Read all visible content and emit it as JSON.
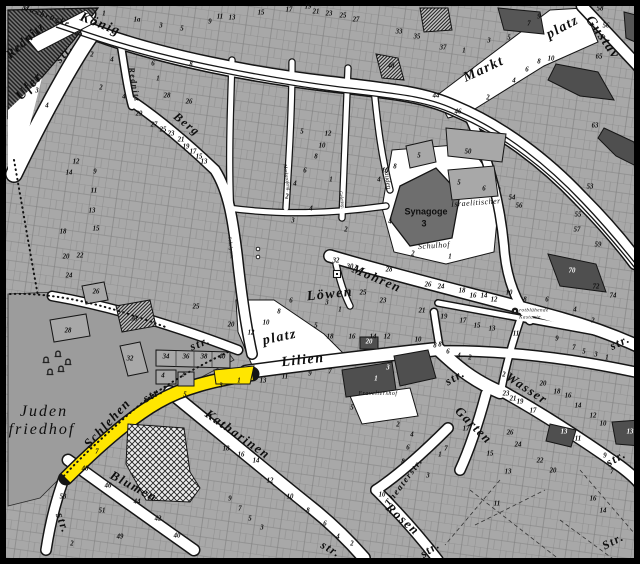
{
  "map": {
    "colors": {
      "highlight": "#ffe600",
      "block": "#a8a8a8",
      "block_dark": "#4f4f4f",
      "street": "#ffffff",
      "outline": "#151515",
      "cemetery": "#9c9c9c",
      "river": "#7c7c7c"
    },
    "street_labels": [
      {
        "t": "Maxbrücke",
        "x": 46,
        "y": 16,
        "r": 20,
        "s": 8,
        "n": "label-maxbruecke"
      },
      {
        "t": "Rednitz",
        "x": 25,
        "y": 40,
        "r": -42,
        "s": 13,
        "c": "riv",
        "n": "label-rednitz-river"
      },
      {
        "t": "König",
        "x": 100,
        "y": 25,
        "r": 22,
        "s": 14,
        "n": "label-koenigstrasse"
      },
      {
        "t": "str.",
        "x": 64,
        "y": 53,
        "r": -50,
        "s": 12,
        "n": "label-ufer-str-suffix"
      },
      {
        "t": "Ufer",
        "x": 30,
        "y": 87,
        "r": -47,
        "s": 14,
        "n": "label-uferstrasse"
      },
      {
        "t": "Rednitz",
        "x": 134,
        "y": 85,
        "r": 80,
        "s": 8,
        "n": "label-rednitzgasse"
      },
      {
        "t": "Berg",
        "x": 187,
        "y": 124,
        "r": 38,
        "s": 12,
        "n": "label-bergstrasse"
      },
      {
        "t": "Markt",
        "x": 484,
        "y": 70,
        "r": -25,
        "s": 14,
        "n": "label-marktplatz"
      },
      {
        "t": "platz",
        "x": 563,
        "y": 28,
        "r": -28,
        "s": 14,
        "n": "label-marktplatz-suffix"
      },
      {
        "t": "Gustav",
        "x": 602,
        "y": 38,
        "r": 55,
        "s": 14,
        "n": "label-gustavstrasse"
      },
      {
        "t": "Stauden",
        "x": 387,
        "y": 178,
        "r": 82,
        "s": 7,
        "c": "tiny",
        "n": "label-staudengasse"
      },
      {
        "t": "Markgrafeng.",
        "x": 286,
        "y": 178,
        "r": 82,
        "s": 5,
        "c": "tiny",
        "n": "label-markgrafengasse"
      },
      {
        "t": "Geleitsg.",
        "x": 341,
        "y": 200,
        "r": 82,
        "s": 5,
        "c": "tiny",
        "n": "label-geleitsgasse"
      },
      {
        "t": "Schulgasse",
        "x": 230,
        "y": 248,
        "r": 84,
        "s": 5,
        "c": "tiny",
        "n": "label-schulgasse"
      },
      {
        "t": "Mohren",
        "x": 377,
        "y": 278,
        "r": 23,
        "s": 13,
        "n": "label-mohrenstrasse"
      },
      {
        "t": "str.",
        "x": 620,
        "y": 342,
        "r": -25,
        "s": 12,
        "n": "label-mohren-str-suffix"
      },
      {
        "t": "Löwen",
        "x": 330,
        "y": 295,
        "r": -6,
        "s": 14,
        "n": "label-loewenplatz"
      },
      {
        "t": "platz",
        "x": 280,
        "y": 338,
        "r": -12,
        "s": 14,
        "n": "label-loewenplatz-suffix"
      },
      {
        "t": "str.",
        "x": 200,
        "y": 343,
        "r": -22,
        "s": 12,
        "n": "label-berg-str-suffix"
      },
      {
        "t": "Lilien",
        "x": 303,
        "y": 361,
        "r": -6,
        "s": 14,
        "n": "label-lilienstrasse"
      },
      {
        "t": "str.",
        "x": 455,
        "y": 377,
        "r": -30,
        "s": 12,
        "n": "label-lilien-str-suffix"
      },
      {
        "t": "Schlehen",
        "x": 107,
        "y": 423,
        "r": -47,
        "s": 13,
        "n": "label-schlehenstrasse"
      },
      {
        "t": "str.",
        "x": 153,
        "y": 394,
        "r": -30,
        "s": 12,
        "n": "label-schlehen-str-suffix"
      },
      {
        "t": "Katharinen",
        "x": 238,
        "y": 434,
        "r": 35,
        "s": 13,
        "n": "label-katharinenstrasse"
      },
      {
        "t": "str.",
        "x": 331,
        "y": 549,
        "r": 30,
        "s": 12,
        "n": "label-katharinen-str-suffix"
      },
      {
        "t": "Blumen",
        "x": 134,
        "y": 486,
        "r": 28,
        "s": 13,
        "n": "label-blumenstrasse"
      },
      {
        "t": "str.",
        "x": 63,
        "y": 523,
        "r": 70,
        "s": 12,
        "n": "label-blumen-str-suffix"
      },
      {
        "t": "Wasser",
        "x": 527,
        "y": 388,
        "r": 33,
        "s": 13,
        "n": "label-wasserstrasse"
      },
      {
        "t": "Garten",
        "x": 474,
        "y": 425,
        "r": 45,
        "s": 13,
        "n": "label-gartenstrasse"
      },
      {
        "t": "Theaterstr.",
        "x": 404,
        "y": 482,
        "r": -53,
        "s": 9,
        "n": "label-theaterstrasse"
      },
      {
        "t": "Rosen",
        "x": 403,
        "y": 519,
        "r": 42,
        "s": 13,
        "n": "label-rosenstrasse"
      },
      {
        "t": "str.",
        "x": 430,
        "y": 549,
        "r": -35,
        "s": 12,
        "n": "label-rosen-str-suffix"
      },
      {
        "t": "str.",
        "x": 616,
        "y": 458,
        "r": -30,
        "s": 12,
        "n": "label-garten-str-suffix"
      },
      {
        "t": "Str.",
        "x": 613,
        "y": 541,
        "r": -28,
        "s": 12,
        "n": "label-wasser-str-suffix"
      }
    ],
    "poi_labels": [
      {
        "t": "Juden",
        "x": 44,
        "y": 412,
        "s": 16,
        "c": "cem",
        "n": "label-judenfriedhof-1"
      },
      {
        "t": "friedhof",
        "x": 42,
        "y": 430,
        "s": 16,
        "c": "cem",
        "n": "label-judenfriedhof-2"
      },
      {
        "t": "Synagoge",
        "x": 426,
        "y": 212,
        "s": 9,
        "c": "b",
        "n": "label-synagoge"
      },
      {
        "t": "3",
        "x": 424,
        "y": 224,
        "s": 9,
        "c": "b",
        "n": "label-synagoge-number"
      },
      {
        "t": "Israelitischer",
        "x": 476,
        "y": 203,
        "r": -4,
        "s": 8,
        "c": "i",
        "n": "label-israelitischer"
      },
      {
        "t": "Schulhof",
        "x": 434,
        "y": 246,
        "r": -4,
        "s": 8,
        "c": "i",
        "n": "label-schulhof"
      },
      {
        "t": "Fraveliershof",
        "x": 378,
        "y": 394,
        "s": 6,
        "c": "i",
        "n": "label-fraveliershof"
      },
      {
        "t": "rotblühende",
        "x": 534,
        "y": 311,
        "s": 5,
        "c": "i",
        "n": "label-kastanie-1"
      },
      {
        "t": "Kastanie",
        "x": 530,
        "y": 318,
        "s": 5,
        "c": "i",
        "n": "label-kastanie-2"
      }
    ],
    "house_numbers": [
      [
        "1",
        104,
        15
      ],
      [
        "1a",
        137,
        21
      ],
      [
        "3",
        161,
        27
      ],
      [
        "5",
        182,
        30
      ],
      [
        "9",
        210,
        23
      ],
      [
        "11",
        220,
        18
      ],
      [
        "13",
        232,
        19
      ],
      [
        "15",
        261,
        14
      ],
      [
        "17",
        289,
        11
      ],
      [
        "19",
        308,
        8
      ],
      [
        "21",
        316,
        13
      ],
      [
        "23",
        329,
        15
      ],
      [
        "25",
        343,
        17
      ],
      [
        "27",
        356,
        21
      ],
      [
        "33",
        399,
        33
      ],
      [
        "35",
        417,
        38
      ],
      [
        "37",
        443,
        49
      ],
      [
        "1",
        464,
        52
      ],
      [
        "3",
        489,
        42
      ],
      [
        "5",
        509,
        39
      ],
      [
        "7",
        529,
        25
      ],
      [
        "9",
        539,
        18
      ],
      [
        "58",
        600,
        10
      ],
      [
        "56",
        606,
        27
      ],
      [
        "2",
        488,
        99
      ],
      [
        "4",
        514,
        82
      ],
      [
        "6",
        527,
        71
      ],
      [
        "8",
        539,
        63
      ],
      [
        "10",
        551,
        60
      ],
      [
        "44",
        436,
        97
      ],
      [
        "46",
        458,
        113
      ],
      [
        "65",
        599,
        58
      ],
      [
        "63",
        595,
        127
      ],
      [
        "40",
        391,
        67
      ],
      [
        "53",
        590,
        188
      ],
      [
        "55",
        578,
        216
      ],
      [
        "57",
        577,
        231
      ],
      [
        "59",
        598,
        246
      ],
      [
        "2",
        92,
        56
      ],
      [
        "4",
        112,
        61
      ],
      [
        "6",
        153,
        65
      ],
      [
        "8",
        191,
        66
      ],
      [
        "1",
        158,
        80
      ],
      [
        "28",
        167,
        97
      ],
      [
        "26",
        189,
        103
      ],
      [
        "3",
        37,
        92
      ],
      [
        "4",
        47,
        107
      ],
      [
        "2",
        101,
        89
      ],
      [
        "4",
        124,
        98
      ],
      [
        "29",
        139,
        115
      ],
      [
        "27",
        154,
        126
      ],
      [
        "25",
        163,
        131
      ],
      [
        "23",
        171,
        135
      ],
      [
        "21",
        181,
        141
      ],
      [
        "19",
        186,
        148
      ],
      [
        "17",
        193,
        153
      ],
      [
        "15",
        199,
        158
      ],
      [
        "13",
        204,
        163
      ],
      [
        "12",
        76,
        163
      ],
      [
        "14",
        69,
        174
      ],
      [
        "9",
        95,
        173
      ],
      [
        "11",
        94,
        192
      ],
      [
        "13",
        92,
        212
      ],
      [
        "15",
        96,
        230
      ],
      [
        "18",
        63,
        233
      ],
      [
        "20",
        66,
        258
      ],
      [
        "22",
        80,
        257
      ],
      [
        "24",
        69,
        277
      ],
      [
        "26",
        96,
        293
      ],
      [
        "28",
        68,
        332
      ],
      [
        "30",
        134,
        320
      ],
      [
        "32",
        130,
        360
      ],
      [
        "5",
        302,
        133
      ],
      [
        "12",
        328,
        135
      ],
      [
        "10",
        322,
        147
      ],
      [
        "8",
        316,
        158
      ],
      [
        "6",
        305,
        172
      ],
      [
        "4",
        295,
        185
      ],
      [
        "2",
        287,
        198
      ],
      [
        "1",
        331,
        181
      ],
      [
        "3",
        293,
        222
      ],
      [
        "4",
        311,
        210
      ],
      [
        "8",
        395,
        168
      ],
      [
        "10",
        385,
        172
      ],
      [
        "4",
        379,
        181
      ],
      [
        "5",
        419,
        157
      ],
      [
        "50",
        468,
        153
      ],
      [
        "5",
        459,
        184
      ],
      [
        "6",
        484,
        190
      ],
      [
        "54",
        512,
        199
      ],
      [
        "56",
        519,
        207
      ],
      [
        "32",
        336,
        262
      ],
      [
        "30",
        350,
        268
      ],
      [
        "28",
        389,
        271
      ],
      [
        "2",
        346,
        231
      ],
      [
        "4",
        390,
        223
      ],
      [
        "2",
        413,
        255
      ],
      [
        "1",
        450,
        258
      ],
      [
        "26",
        428,
        286
      ],
      [
        "24",
        441,
        288
      ],
      [
        "25",
        196,
        308
      ],
      [
        "20",
        231,
        326
      ],
      [
        "12",
        251,
        334
      ],
      [
        "10",
        266,
        324
      ],
      [
        "8",
        279,
        313
      ],
      [
        "6",
        291,
        302
      ],
      [
        "3",
        327,
        304
      ],
      [
        "1",
        340,
        311
      ],
      [
        "5",
        316,
        327
      ],
      [
        "18",
        330,
        338
      ],
      [
        "16",
        352,
        338
      ],
      [
        "14",
        373,
        338
      ],
      [
        "12",
        387,
        338
      ],
      [
        "25",
        363,
        294
      ],
      [
        "23",
        383,
        302
      ],
      [
        "21",
        422,
        312
      ],
      [
        "19",
        444,
        318
      ],
      [
        "10",
        418,
        341
      ],
      [
        "8",
        440,
        346
      ],
      [
        "20",
        369,
        343,
        "inv"
      ],
      [
        "18",
        462,
        292
      ],
      [
        "16",
        473,
        297
      ],
      [
        "14",
        484,
        297
      ],
      [
        "12",
        494,
        301
      ],
      [
        "10",
        509,
        294
      ],
      [
        "8",
        525,
        301
      ],
      [
        "6",
        547,
        301
      ],
      [
        "70",
        572,
        272,
        "inv"
      ],
      [
        "72",
        596,
        288
      ],
      [
        "74",
        613,
        297
      ],
      [
        "4",
        575,
        311
      ],
      [
        "2",
        593,
        322
      ],
      [
        "17",
        463,
        322
      ],
      [
        "15",
        477,
        327
      ],
      [
        "13",
        492,
        330
      ],
      [
        "11",
        516,
        335
      ],
      [
        "9",
        557,
        340
      ],
      [
        "7",
        574,
        349
      ],
      [
        "5",
        584,
        353
      ],
      [
        "3",
        596,
        356
      ],
      [
        "1",
        607,
        359
      ],
      [
        "8",
        435,
        347
      ],
      [
        "6",
        448,
        353
      ],
      [
        "4",
        459,
        357
      ],
      [
        "2",
        470,
        359
      ],
      [
        "34",
        166,
        358
      ],
      [
        "36",
        186,
        358
      ],
      [
        "38",
        204,
        358
      ],
      [
        "40",
        222,
        358
      ],
      [
        "4",
        163,
        377
      ],
      [
        "2",
        183,
        376
      ],
      [
        "5",
        185,
        396
      ],
      [
        "3",
        221,
        387
      ],
      [
        "1",
        239,
        382
      ],
      [
        "13",
        263,
        382
      ],
      [
        "11",
        285,
        378
      ],
      [
        "9",
        310,
        375
      ],
      [
        "7",
        330,
        373
      ],
      [
        "3",
        388,
        369,
        "inv"
      ],
      [
        "1",
        376,
        380,
        "inv"
      ],
      [
        "5",
        352,
        409
      ],
      [
        "2",
        398,
        426
      ],
      [
        "4",
        412,
        436
      ],
      [
        "6",
        408,
        449
      ],
      [
        "8",
        403,
        463
      ],
      [
        "10",
        382,
        496
      ],
      [
        "17",
        466,
        430
      ],
      [
        "7",
        446,
        450
      ],
      [
        "1",
        440,
        456
      ],
      [
        "3",
        428,
        477
      ],
      [
        "2",
        504,
        376
      ],
      [
        "20",
        543,
        385
      ],
      [
        "18",
        557,
        393
      ],
      [
        "16",
        568,
        397
      ],
      [
        "14",
        578,
        407
      ],
      [
        "12",
        593,
        417
      ],
      [
        "10",
        603,
        425
      ],
      [
        "23",
        506,
        395
      ],
      [
        "21",
        513,
        400
      ],
      [
        "19",
        520,
        403
      ],
      [
        "17",
        533,
        412
      ],
      [
        "13",
        564,
        433,
        "inv"
      ],
      [
        "11",
        578,
        440
      ],
      [
        "26",
        510,
        434
      ],
      [
        "24",
        518,
        446
      ],
      [
        "22",
        540,
        462
      ],
      [
        "20",
        553,
        472
      ],
      [
        "15",
        490,
        455
      ],
      [
        "13",
        508,
        473
      ],
      [
        "11",
        497,
        505
      ],
      [
        "13",
        630,
        433,
        "inv"
      ],
      [
        "9",
        605,
        457
      ],
      [
        "7",
        612,
        473
      ],
      [
        "16",
        593,
        500
      ],
      [
        "14",
        603,
        512
      ],
      [
        "18",
        226,
        450
      ],
      [
        "16",
        241,
        456
      ],
      [
        "14",
        256,
        462
      ],
      [
        "12",
        270,
        482
      ],
      [
        "10",
        290,
        498
      ],
      [
        "8",
        308,
        512
      ],
      [
        "6",
        325,
        525
      ],
      [
        "4",
        338,
        538
      ],
      [
        "2",
        352,
        545
      ],
      [
        "9",
        230,
        500
      ],
      [
        "7",
        240,
        510
      ],
      [
        "5",
        250,
        520
      ],
      [
        "3",
        262,
        529
      ],
      [
        "48",
        85,
        470
      ],
      [
        "46",
        108,
        487
      ],
      [
        "44",
        137,
        503
      ],
      [
        "42",
        158,
        520
      ],
      [
        "40",
        177,
        537
      ],
      [
        "53",
        63,
        498
      ],
      [
        "51",
        102,
        512
      ],
      [
        "49",
        120,
        538
      ],
      [
        "2",
        72,
        545
      ],
      [
        "7",
        97,
        453
      ]
    ],
    "symbols": [
      {
        "name": "gravestone-icon"
      },
      {
        "name": "tree-icon rotbluehende-kastanie"
      },
      {
        "name": "square-marker-icon"
      },
      {
        "name": "bridge-maxbruecke"
      }
    ]
  }
}
